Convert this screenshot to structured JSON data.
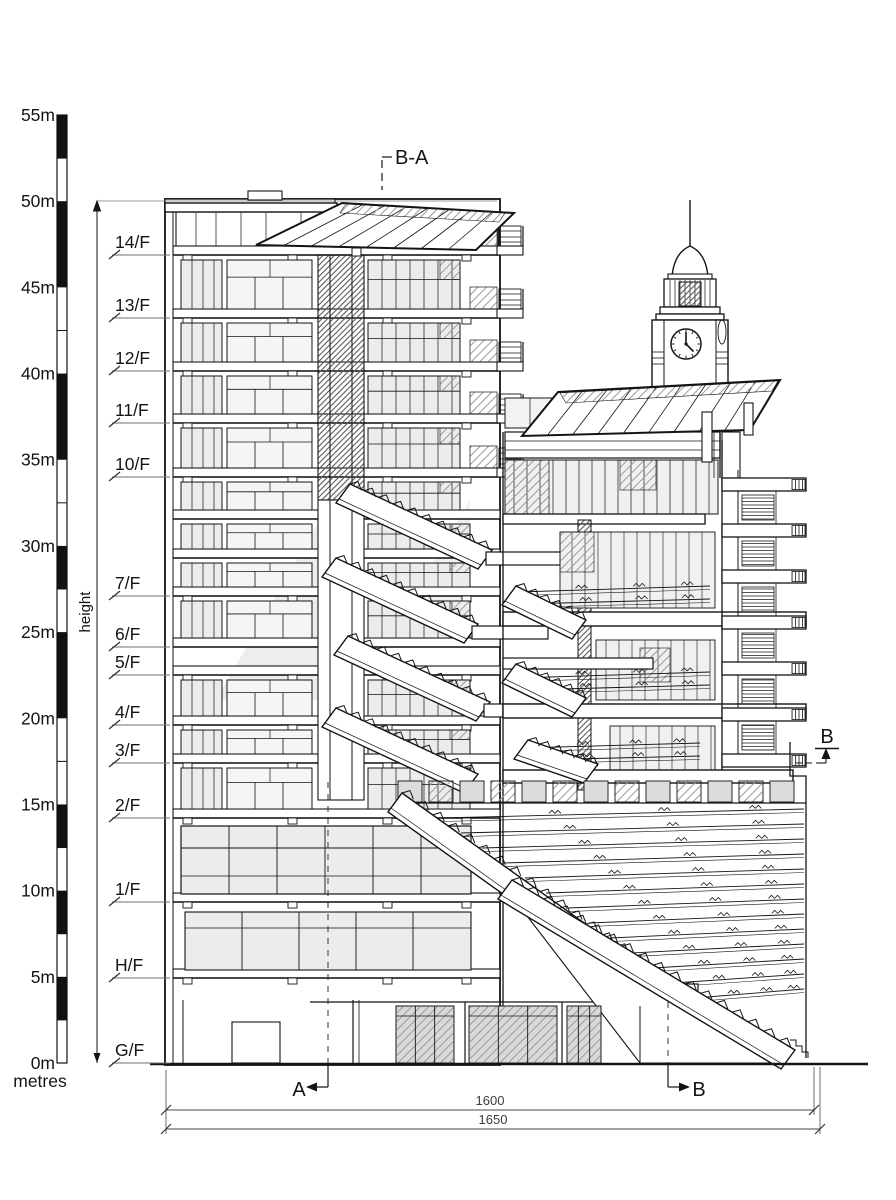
{
  "colors": {
    "ink": "#141414",
    "leader": "#7a7a7a",
    "dim": "#3c3c3c",
    "glass": "#e4e4e4",
    "shade": "#ededed",
    "hatch": "#8f8f8f"
  },
  "scale_bar": {
    "unit_label": "metres",
    "tick_labels": [
      "55m",
      "50m",
      "45m",
      "40m",
      "35m",
      "30m",
      "25m",
      "20m",
      "15m",
      "10m",
      "5m",
      "0m"
    ]
  },
  "height_dimension": {
    "label": "height"
  },
  "floors": [
    {
      "label": "14/F"
    },
    {
      "label": "13/F"
    },
    {
      "label": "12/F"
    },
    {
      "label": "11/F"
    },
    {
      "label": "10/F"
    },
    {
      "label": "7/F"
    },
    {
      "label": "6/F"
    },
    {
      "label": "5/F"
    },
    {
      "label": "4/F"
    },
    {
      "label": "3/F"
    },
    {
      "label": "2/F"
    },
    {
      "label": "1/F"
    },
    {
      "label": "H/F"
    },
    {
      "label": "G/F"
    }
  ],
  "section_markers": {
    "top_label": "B-A",
    "bottom_left_label": "A",
    "bottom_right_label": "B",
    "right_label": "B"
  },
  "dimensions": {
    "inner_label": "1600",
    "outer_label": "1650"
  },
  "clock_tower": {
    "time_depicted": "12:23"
  }
}
